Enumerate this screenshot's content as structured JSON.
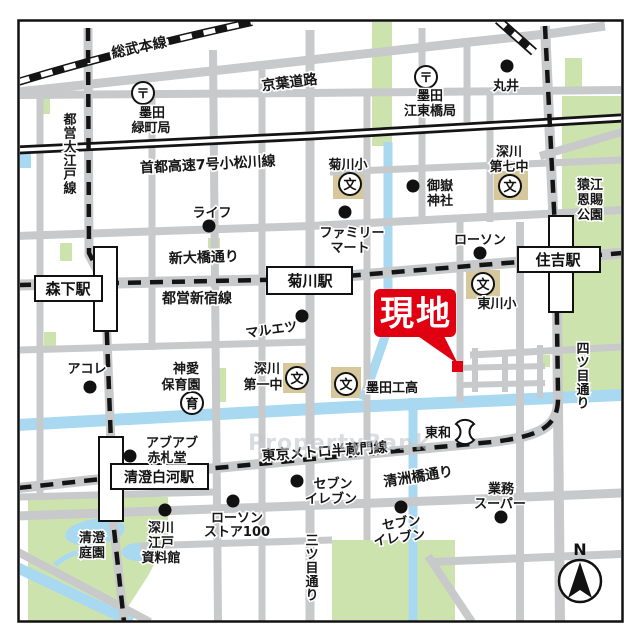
{
  "site": {
    "label": "現地"
  },
  "compass": {
    "n": "N"
  },
  "watermark": "PropertyBank",
  "symbols": {
    "post_office": "〒",
    "school": "文",
    "nursery": "育"
  },
  "railways": {
    "sobu": "総武本線",
    "shuto_expwy": "首都高速7号小松川線",
    "oedo": "都営大江戸線",
    "shinjuku": "都営新宿線",
    "hanzomon": "東京メトロ半蔵門線"
  },
  "roads": {
    "keiyo": "京葉道路",
    "shin_ohashi": "新大橋通り",
    "kiyosubashi": "清洲橋通り",
    "mitsume": "三ツ目通り",
    "yotsume": "四ツ目通り"
  },
  "stations": {
    "morishita": "森下駅",
    "kikukawa": "菊川駅",
    "sumiyoshi": "住吉駅",
    "kiyosumi_shirakawa": "清澄白河駅"
  },
  "pois": {
    "midoricho_po": [
      "墨田",
      "緑町局"
    ],
    "kotobashi_po": [
      "墨田",
      "江東橋局"
    ],
    "marui": "丸井",
    "kikukawa_elem": "菊川小",
    "mitake_shrine": [
      "御嶽",
      "神社"
    ],
    "fukagawa7_jhs": [
      "深川",
      "第七中"
    ],
    "sarue_park": [
      "猿江",
      "恩賜",
      "公園"
    ],
    "life": "ライフ",
    "family_mart": [
      "ファミリー",
      "マート"
    ],
    "lawson": "ローソン",
    "higashikawa_elem": "東川小",
    "maruetsu": "マルエツ",
    "acole": "アコレ",
    "shinai_nursery": [
      "神愛",
      "保育園"
    ],
    "fukagawa1_jhs": [
      "深川",
      "第一中"
    ],
    "sumida_tech_hs": "墨田工高",
    "abuabu": [
      "アブアブ",
      "赤札堂"
    ],
    "towa": "東和",
    "seven_eleven": [
      "セブン",
      "イレブン"
    ],
    "lawson_store100": [
      "ローソン",
      "ストア100"
    ],
    "gyomu_super": [
      "業務",
      "スーパー"
    ],
    "kiyosumi_garden": [
      "清澄",
      "庭園"
    ],
    "edo_museum": [
      "深川",
      "江戸",
      "資料館"
    ]
  },
  "colors": {
    "road": "#c8c9ca",
    "water": "#a9d9f1",
    "park": "#cde3ae",
    "school_ground": "#d6c89c",
    "site_red": "#e00012",
    "rail_black": "#141414"
  }
}
